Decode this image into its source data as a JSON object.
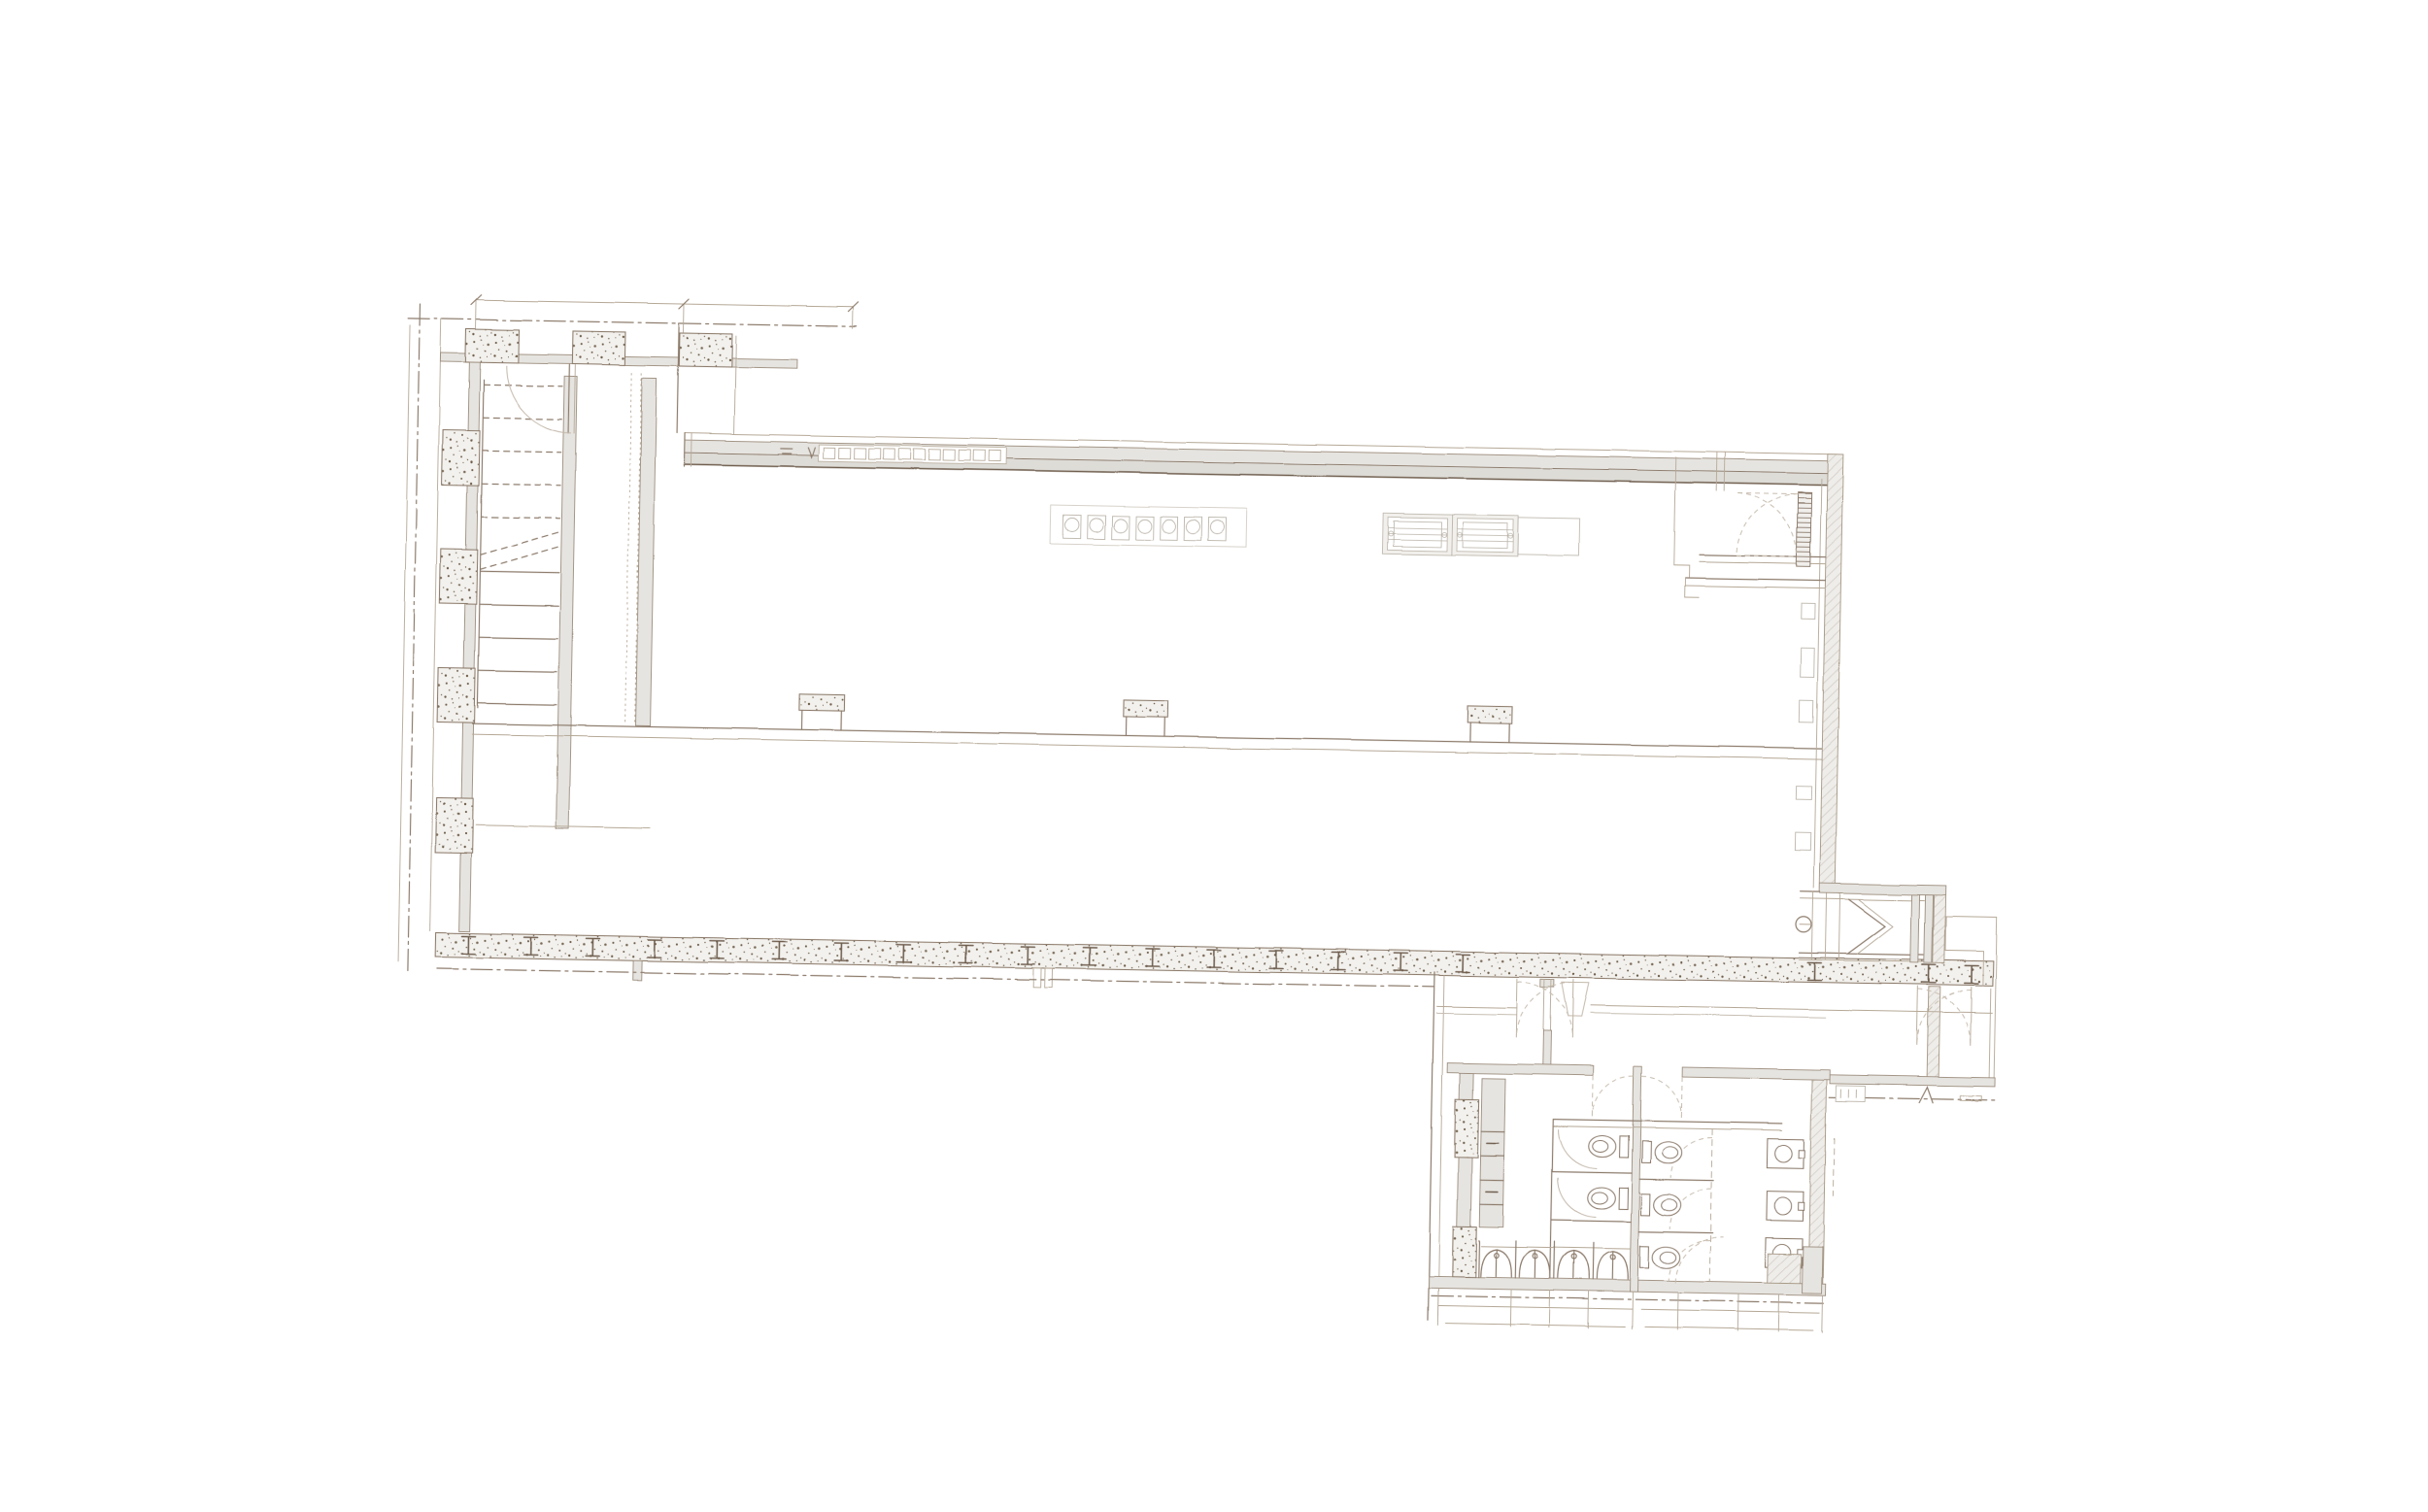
{
  "document": {
    "type": "architectural floor plan",
    "medium": "sepia pencil-sketch CAD drawing on white background",
    "visible_text": "none (annotation marks are illegible scribbles)",
    "sheet_background": "#ffffff"
  },
  "palette": {
    "line_medium": "#8d7c6c",
    "line_dark": "#6e5d4d",
    "line_light": "#b5a896",
    "fixture_light": "#bcb5aa",
    "wall_fill": "#e6e4e0",
    "hatch_fill": "#d8d4ce",
    "stipple_dot": "#6f5f4c",
    "door_arc": "#c7bcae"
  },
  "components": {
    "stair_tower": {
      "name": "left stair tower",
      "treads_dashed": 5,
      "treads_solid": 5,
      "wall_columns": 4,
      "top_columns": 3,
      "door_swings": 1
    },
    "main_hall": {
      "name": "main hall",
      "ceiling_fixtures": 7,
      "grille_units": 2,
      "empty_bays": 1,
      "grid_column_markers": 3,
      "window_cells": 12,
      "steel_I_columns": 20
    },
    "entry_room": {
      "name": "upper-right vestibule",
      "double_door_swings": 2,
      "hatched_door_panels": 1
    },
    "exterior_stair": {
      "name": "small side stair",
      "direction_chevrons": 2
    },
    "right_wing": {
      "name": "right service corridor",
      "double_door_swings": 1
    },
    "restroom_block": {
      "name": "lower-right restroom block",
      "toilets": 5,
      "urinals": 4,
      "sinks": 3,
      "stall_doors": 5,
      "lobby_door_leaves": 2,
      "service_columns": 2,
      "dimension_brackets": 2
    }
  }
}
